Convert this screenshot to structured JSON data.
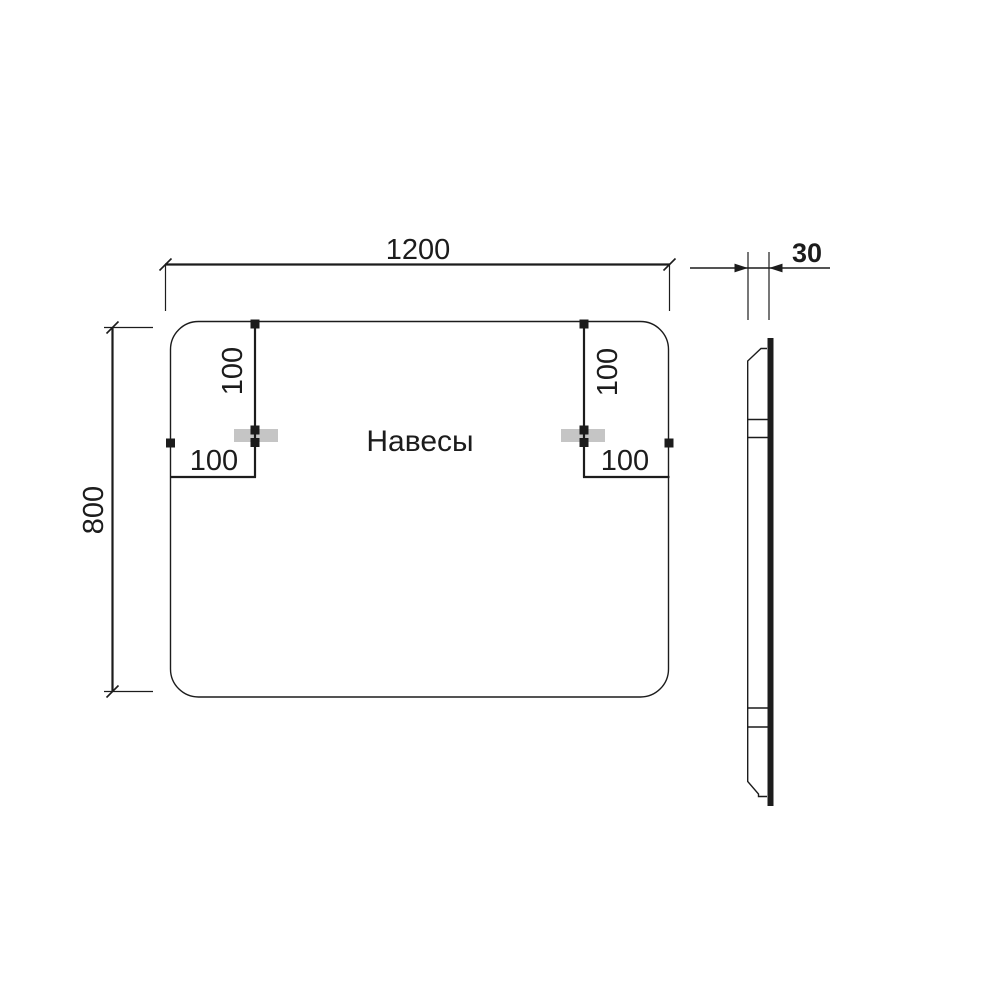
{
  "drawing": {
    "label_hangers": "Навесы",
    "front_view": {
      "width": "1200",
      "height": "800",
      "left_hanger": {
        "top_offset": "100",
        "edge_offset": "100"
      },
      "right_hanger": {
        "top_offset": "100",
        "edge_offset": "100"
      }
    },
    "side_view": {
      "thickness": "30"
    },
    "colors": {
      "line": "#1c1c1c",
      "hanger_fill": "#c5c5c5",
      "background": "#ffffff"
    }
  }
}
